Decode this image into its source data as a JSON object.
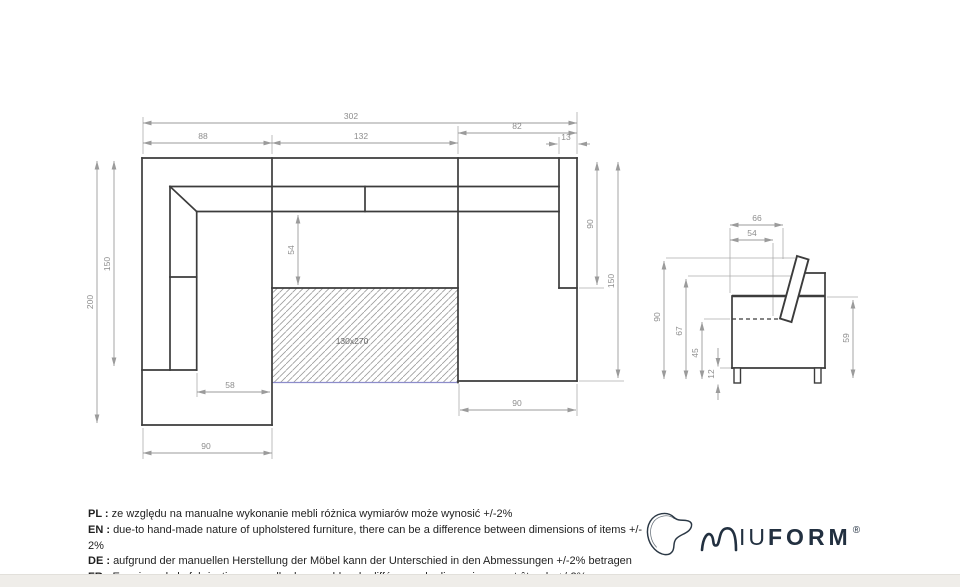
{
  "plan_view": {
    "dims": {
      "overall_width": "302",
      "left_section_width": "88",
      "middle_section_width": "132",
      "right_section_width": "82",
      "right_armrest_width": "13",
      "left_depth_total": "200",
      "left_depth_inner": "150",
      "seat_depth": "54",
      "right_chaise_length": "90",
      "right_depth_total": "150",
      "left_seat_width": "58",
      "left_chaise_width": "90",
      "right_chaise_width": "90",
      "sleeping_area": "130x270"
    }
  },
  "side_view": {
    "dims": {
      "depth_total": "66",
      "seat_depth": "54",
      "height_total": "90",
      "backrest_height": "67",
      "seat_height": "45",
      "leg_height": "12",
      "armrest_height": "59"
    }
  },
  "disclaimer": {
    "0": {
      "label": "PL :",
      "text": "ze względu na manualne wykonanie mebli różnica wymiarów może wynosić +/-2%"
    },
    "1": {
      "label": "EN :",
      "text": "due-to hand-made nature of upholstered furniture, there can be a difference between dimensions of items +/- 2%"
    },
    "2": {
      "label": "DE :",
      "text": "aufgrund der manuellen Herstellung der Möbel kann der Unterschied in den Abmessungen +/-2% betragen"
    },
    "3": {
      "label": "FR :",
      "text": "En raison de la fabrication manuelle des meubles, la différence de dimensions peut être de +/-2%"
    }
  },
  "logo": {
    "brand_light": "IU",
    "brand_bold": "FORM",
    "registered": "®"
  },
  "colors": {
    "outline": "#3c3c3c",
    "dimension": "#9b9b9b",
    "hatch_accent": "#8d8dcb",
    "logo": "#223040"
  }
}
